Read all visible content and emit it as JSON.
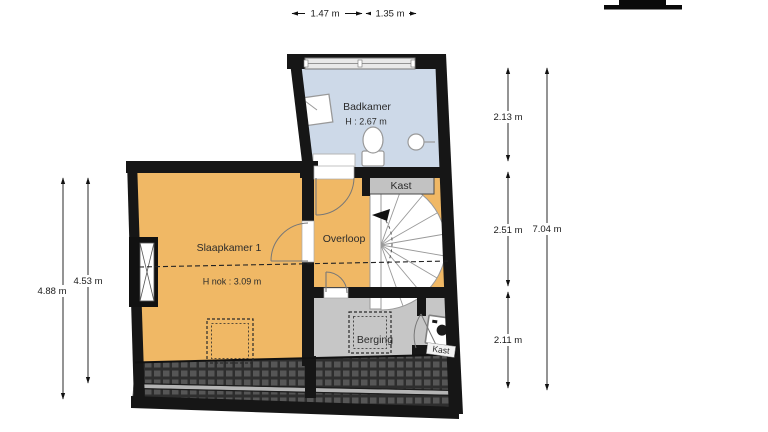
{
  "labels": {
    "badkamer": "Badkamer",
    "badkamer_height": "H : 2.67 m",
    "slaapkamer": "Slaapkamer 1",
    "slaapkamer_height": "H nok : 3.09 m",
    "overloop": "Overloop",
    "kast_top": "Kast",
    "berging": "Berging",
    "kast_bottom": "Kast"
  },
  "dimensions": {
    "top": [
      "1.47 m",
      "1.35 m"
    ],
    "right_segments": [
      "2.13 m",
      "2.51 m",
      "2.11 m"
    ],
    "right_total": "7.04 m",
    "left_outer": "4.88 m",
    "left_inner": "4.53 m"
  },
  "colors": {
    "wall": "#161616",
    "bathroom_floor": "#cdd9e8",
    "room_floor_orange": "#f0b865",
    "storage_floor": "#c6c6c6",
    "closet_box": "#c2c2c2",
    "window_glass": "#e9e9e9"
  }
}
